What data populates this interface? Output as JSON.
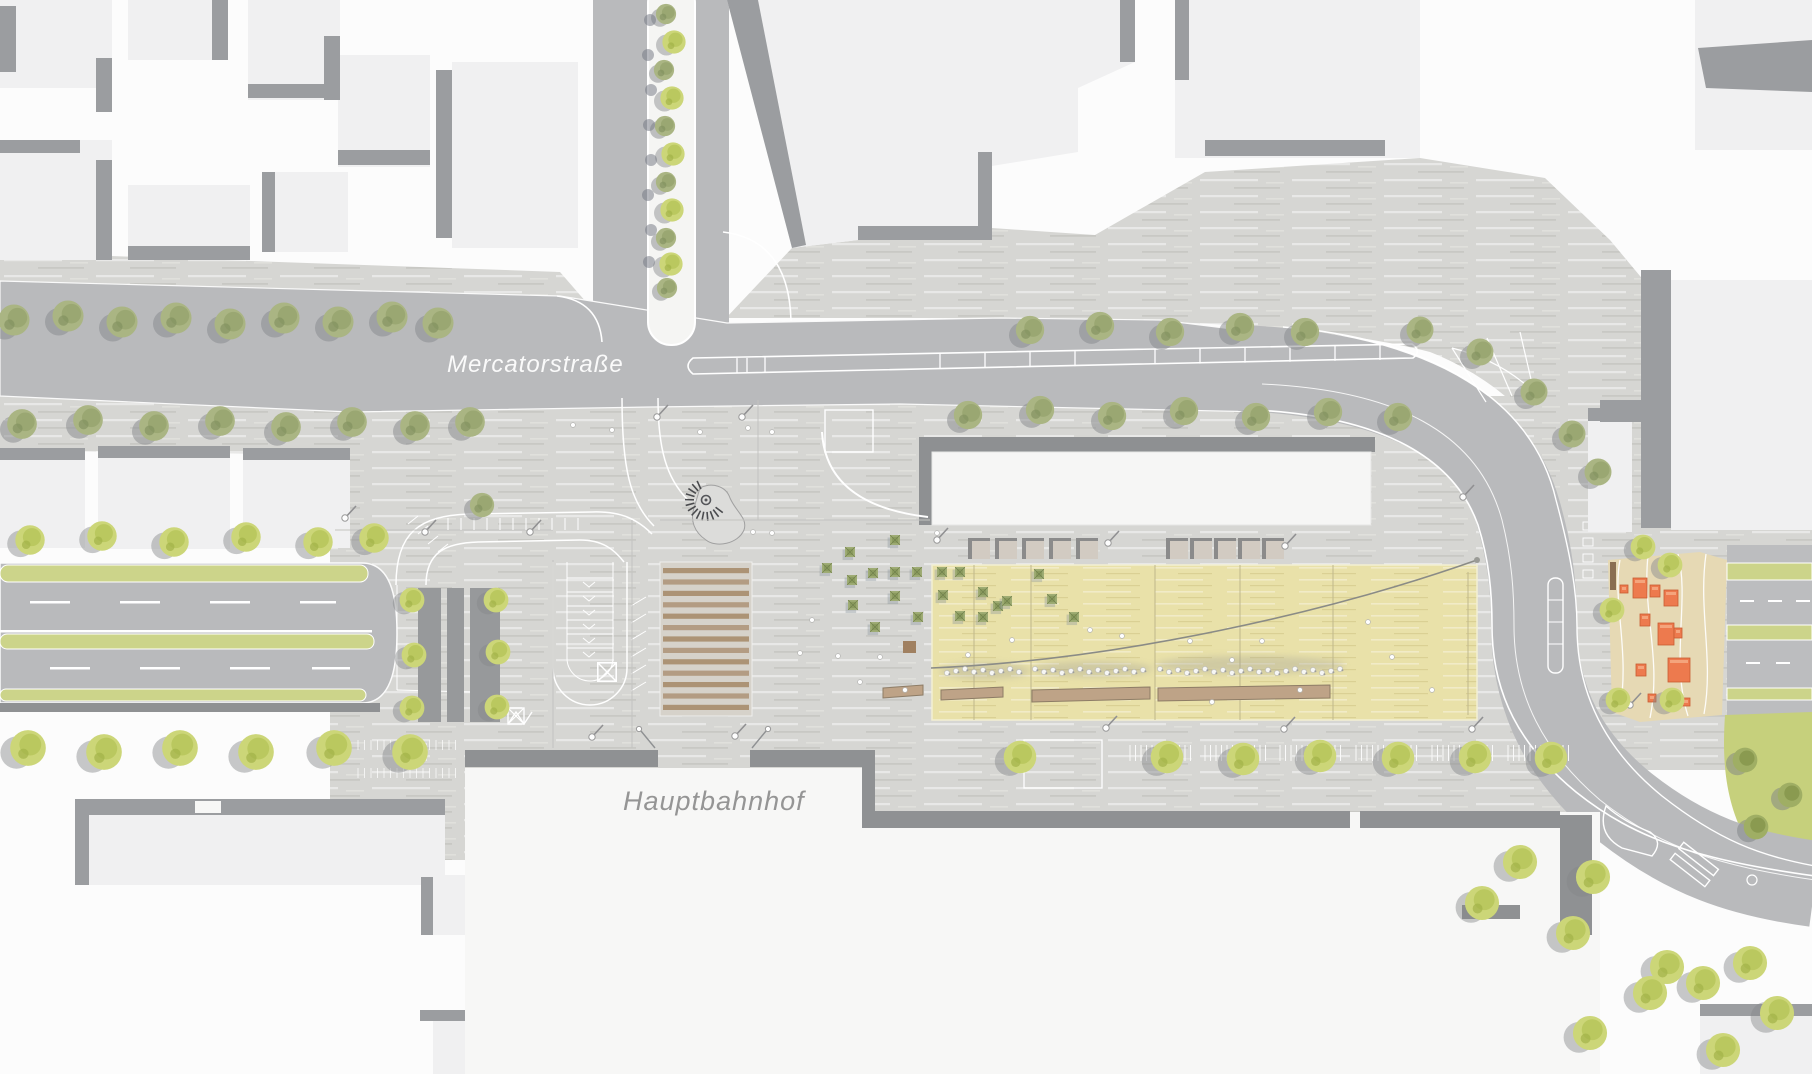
{
  "map": {
    "type": "architectural-site-plan",
    "labels": {
      "street": "Mercatorstraße",
      "station": "Hauptbahnhof"
    },
    "colors": {
      "paper": "#fcfcfc",
      "building": "#f0f0f1",
      "building_shadow": "#9b9da0",
      "paving": "#d6d6d3",
      "road": "#b9babc",
      "road_marking": "#ffffff",
      "plaza_carpet": "#e9e1a9",
      "wood_stairs": "#aa8f70",
      "bench_wood": "#bea387",
      "playground_surface": "#e6d9b4",
      "playground_equipment": "#ed7a4e",
      "green_verge": "#ccd48a",
      "lawn": "#c6d07c",
      "tree_olive": "#aab583",
      "tree_bright": "#ccd678",
      "label_gray": "#959595"
    }
  }
}
